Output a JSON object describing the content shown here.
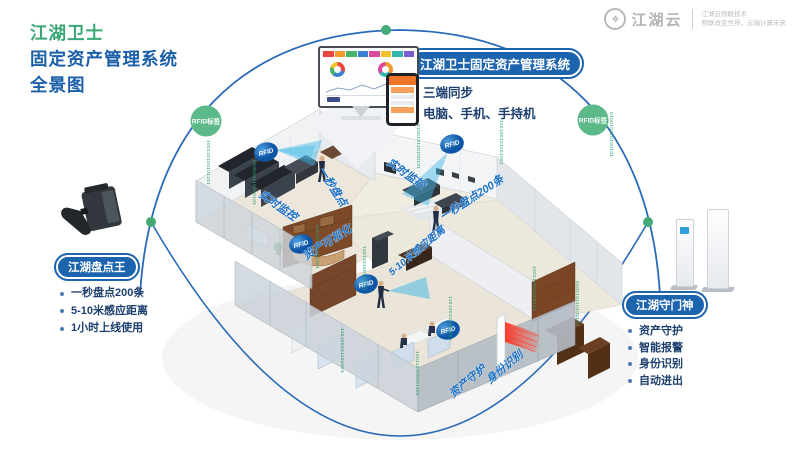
{
  "title": {
    "line1": "江湖卫士",
    "line2": "固定资产管理系统",
    "line3": "全景图"
  },
  "logo": {
    "name": "江湖云",
    "tagline1": "江湖云物联技术",
    "tagline2": "物联改变世界，云端计算未来"
  },
  "nodes": {
    "left": "RFID标签",
    "right": "RFID标签"
  },
  "callouts": {
    "system": {
      "label": "江湖卫士固定资产管理系统",
      "bullets": [
        "三端同步",
        "电脑、手机、手持机"
      ]
    },
    "scanner": {
      "label": "江湖盘点王",
      "bullets": [
        "一秒盘点200条",
        "5-10米感应距离",
        "1小时上线使用"
      ]
    },
    "gate": {
      "label": "江湖守门神",
      "bullets": [
        "资产守护",
        "智能报警",
        "身份识别",
        "自动进出"
      ]
    }
  },
  "building": {
    "rfid_tag": "RFID",
    "labels": [
      "一秒盘点",
      "实时监控",
      "实时监控",
      "一秒盘点200条",
      "资产可视化",
      "5-10米感应距离",
      "资产守护",
      "身份识别"
    ],
    "binary": {
      "a": "100110100101101",
      "b": "010010110100101",
      "c": "110100101101001"
    }
  },
  "colors": {
    "accent_green": "#3aa875",
    "accent_blue": "#1b5faa",
    "pill_blue": "#1d64ae",
    "dome_blue": "#2a6ab8",
    "node_green": "#5cb98a",
    "binary_green": "#2ba272",
    "label_blue": "#1a6fc4",
    "laser_red": "#f43b2a"
  }
}
